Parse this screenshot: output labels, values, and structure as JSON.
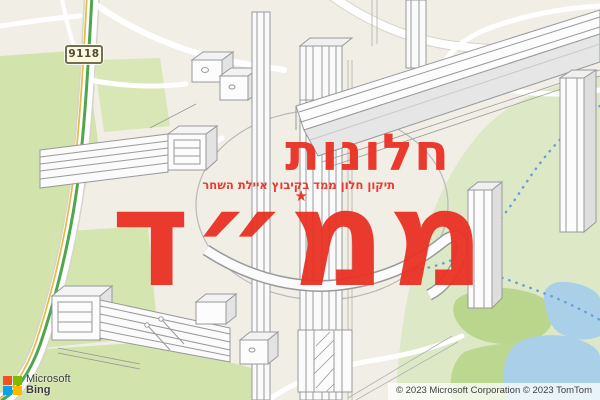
{
  "map": {
    "route_shield": {
      "label": "9118"
    },
    "attribution": "© 2023 Microsoft Corporation © 2023 TomTom",
    "logo": {
      "brand": "Microsoft",
      "product": "Bing"
    }
  },
  "watermark": {
    "title": "חלונות",
    "subtitle": "תיקון חלון ממד בקיבוץ איילת השחר",
    "title2": "ממ״ד",
    "star_icon": "★",
    "color": "#ea3125"
  },
  "colors": {
    "land": "#f1eee6",
    "vegetation_light": "#d5e5af",
    "vegetation_pale": "#dde9c6",
    "forest": "#b9d68c",
    "water": "#a9cfe9",
    "road_fill": "#ffffff",
    "road_casing": "#d8d4c9",
    "route_green_line": "#4fa64f",
    "route_yellow_line": "#e2bf4a",
    "trail_blue": "#64a0d8",
    "drawing_line": "#98999a",
    "microsoft_red": "#f25022",
    "microsoft_green": "#7fba00",
    "microsoft_blue": "#00a4ef",
    "microsoft_yellow": "#ffb900"
  }
}
